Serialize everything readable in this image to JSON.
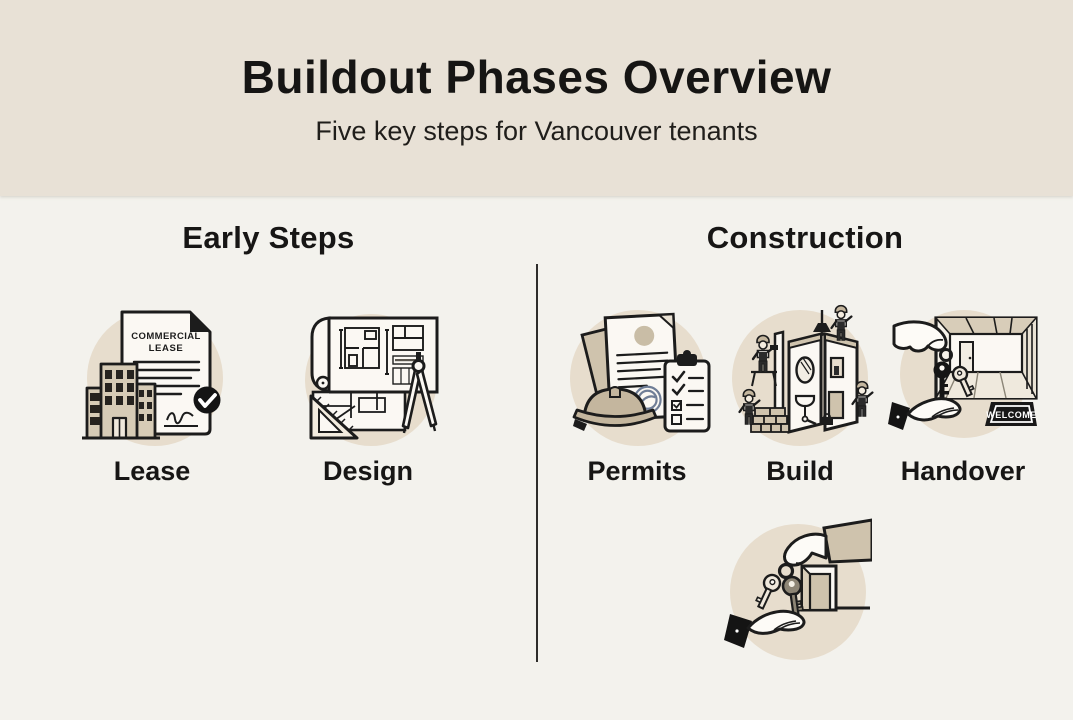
{
  "header": {
    "title": "Buildout Phases Overview",
    "subtitle": "Five key steps for Vancouver tenants"
  },
  "sections": [
    {
      "name": "Early Steps",
      "items": [
        {
          "label": "Lease",
          "icon": "commercial-lease-document-icon"
        },
        {
          "label": "Design",
          "icon": "blueprint-design-icon"
        }
      ]
    },
    {
      "name": "Construction",
      "items": [
        {
          "label": "Permits",
          "icon": "permit-documents-icon"
        },
        {
          "label": "Build",
          "icon": "construction-workers-icon"
        },
        {
          "label": "Handover",
          "icon": "key-handover-icon"
        }
      ]
    }
  ],
  "footer_icon": {
    "name": "keys-exchange-icon"
  },
  "icon_text": {
    "lease_doc_title_line1": "COMMERCIAL",
    "lease_doc_title_line2": "LEASE",
    "welcome_mat": "WELCOME"
  },
  "colors": {
    "header_background": "#e8e1d6",
    "body_background": "#f3f2ed",
    "icon_circle": "#e7ddcd",
    "accent_tan": "#cfc3ad",
    "paper": "#fbf8f3",
    "ink": "#1c1c1c",
    "stamp_blue": "#6f7d96"
  }
}
